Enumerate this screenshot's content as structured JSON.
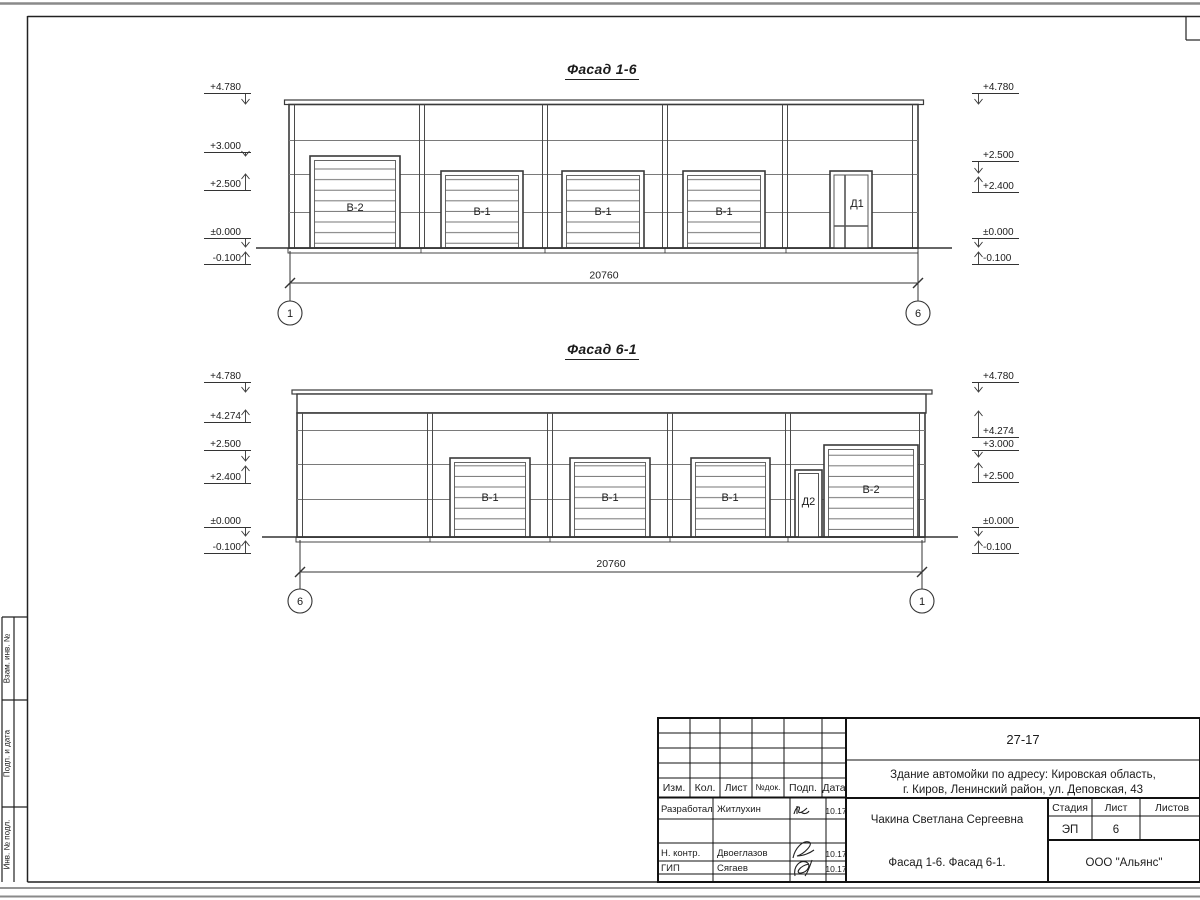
{
  "facade1": {
    "title": "Фасад 1-6",
    "left_marks": [
      "+4.780",
      "+3.000",
      "+2.500",
      "±0.000",
      "-0.100"
    ],
    "right_marks": [
      "+4.780",
      "+2.500",
      "+2.400",
      "±0.000",
      "-0.100"
    ],
    "doors": [
      "В-2",
      "В-1",
      "В-1",
      "В-1",
      "Д1"
    ],
    "dimension": "20760",
    "axis_left": "1",
    "axis_right": "6"
  },
  "facade2": {
    "title": "Фасад 6-1",
    "left_marks": [
      "+4.780",
      "+4.274",
      "+2.500",
      "+2.400",
      "±0.000",
      "-0.100"
    ],
    "right_marks": [
      "+4.780",
      "+4.274",
      "+3.000",
      "+2.500",
      "±0.000",
      "-0.100"
    ],
    "doors": [
      "В-1",
      "В-1",
      "В-1",
      "Д2",
      "В-2"
    ],
    "dimension": "20760",
    "axis_left": "6",
    "axis_right": "1"
  },
  "side_column": {
    "box1": "Взам. инв. №",
    "box2": "Подп. и дата",
    "box3": "Инв. № подл."
  },
  "stamp": {
    "doc_number": "27-17",
    "project_line1": "Здание автомойки по адресу: Кировская область,",
    "project_line2": "г. Киров, Ленинский район, ул. Деповская, 43",
    "col_izm": "Изм.",
    "col_kol": "Кол.",
    "col_list": "Лист",
    "col_ndok": "№док.",
    "col_podp": "Подп.",
    "col_data": "Дата",
    "row1_role": "Разработал",
    "row1_name": "Житлухин",
    "row1_date": "10.17",
    "row2_role": "Н. контр.",
    "row2_name": "Двоеглазов",
    "row2_date": "10.17",
    "row3_role": "ГИП",
    "row3_name": "Сягаев",
    "row3_date": "10.17",
    "client": "Чакина Светлана Сергеевна",
    "sheet_title": "Фасад 1-6. Фасад 6-1.",
    "stage_label": "Стадия",
    "list_label": "Лист",
    "listov_label": "Листов",
    "stage": "ЭП",
    "sheet_no": "6",
    "org": "ООО \"Альянс\""
  }
}
